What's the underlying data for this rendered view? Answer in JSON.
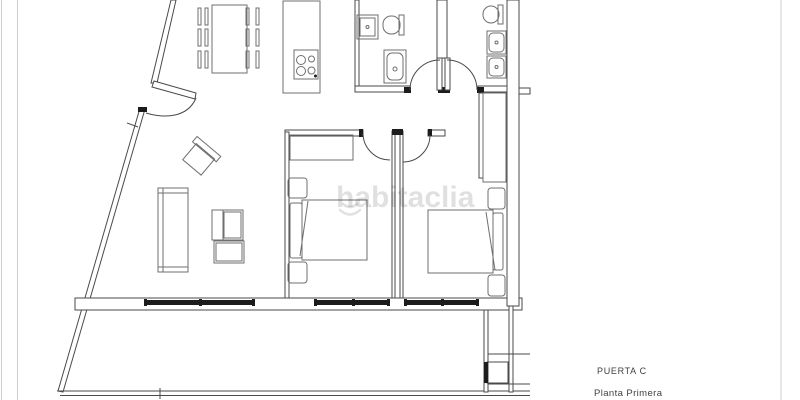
{
  "labels": {
    "door_label": "PUERTA C",
    "floor_label": "Planta Primera"
  },
  "watermark": {
    "text": "habitaclia"
  },
  "colors": {
    "wall": "#4a4a4a",
    "furniture": "#6f6f6f",
    "dark": "#1c1c1c",
    "border": "#cfcfcf",
    "label": "#3f3f3f",
    "watermark": "rgba(0,0,0,0.12)",
    "bg": "#ffffff"
  }
}
